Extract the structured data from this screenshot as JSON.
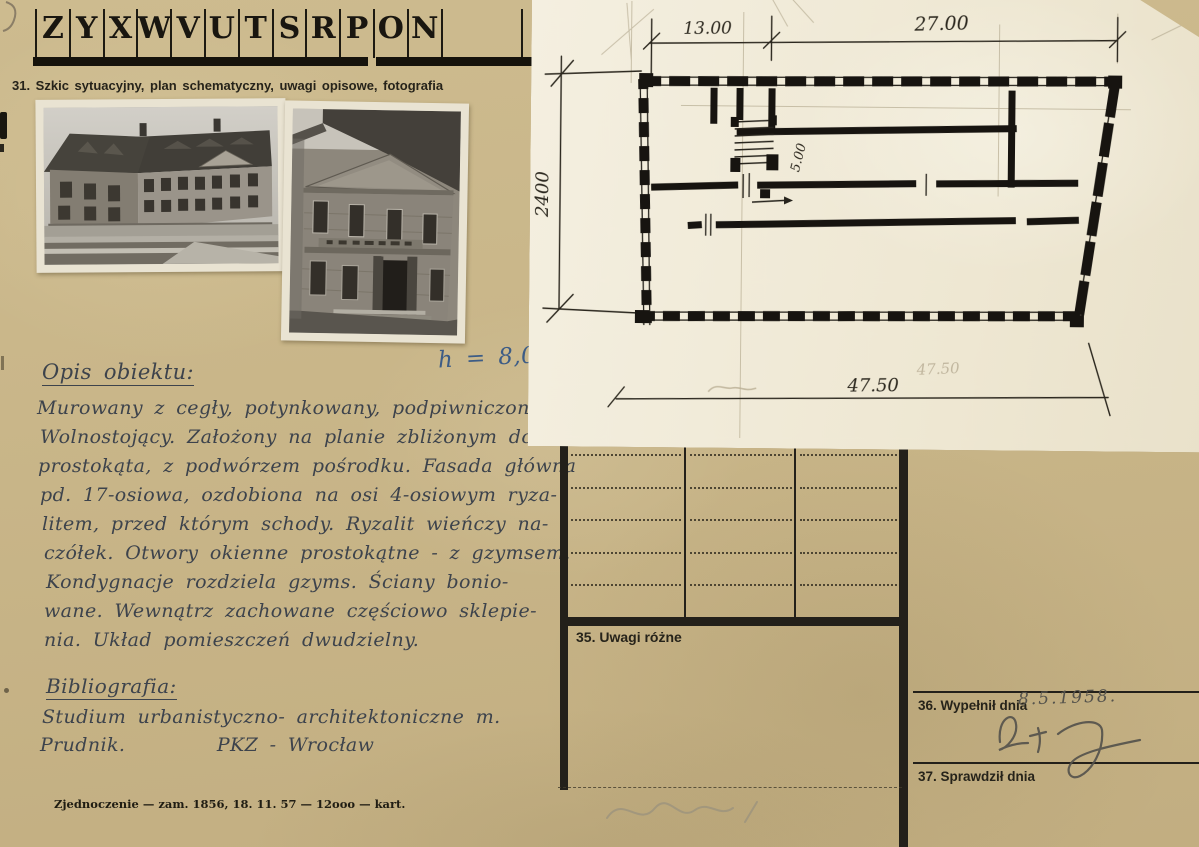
{
  "letter_strip": {
    "letters": [
      "Z",
      "Y",
      "X",
      "W",
      "V",
      "U",
      "T",
      "S",
      "R",
      "P",
      "O",
      "N"
    ]
  },
  "section31": {
    "label": "31. Szkic sytuacyjny, plan schematyczny, uwagi opisowe, fotografia"
  },
  "opis": {
    "heading": "Opis obiektu:",
    "height_note": "h = 8,0",
    "lines": [
      "Murowany z cegły, potynkowany, podpiwniczony.",
      "Wolnostojący. Założony na planie zbliżonym do",
      "prostokąta, z podwórzem pośrodku. Fasada główna",
      "pd. 17-osiowa, ozdobiona na osi 4-osiowym ryza-",
      "litem, przed którym schody. Ryzalit wieńczy na-",
      "czółek. Otwory okienne prostokątne - z gzymsem.",
      "Kondygnacje rozdziela gzyms. Ściany bonio-",
      "wane. Wewnątrz zachowane częściowo sklepie-",
      "nia. Układ pomieszczeń dwudzielny."
    ]
  },
  "bibliografia": {
    "heading": "Bibliografia:",
    "lines": [
      "Studium urbanistyczno- architektoniczne m.",
      "Prudnik.        PKZ - Wrocław"
    ]
  },
  "plan": {
    "dim_top_left": "13.00",
    "dim_top_right": "27.00",
    "dim_left": "2400",
    "dim_bottom": "47.50",
    "dim_bottom_pencil": "47.50",
    "stairs_width": "5.00"
  },
  "form": {
    "uwagi_label": "35. Uwagi różne",
    "wypelnil_label": "36. Wypełnił dnia",
    "wypelnil_date": "8.5.1958.",
    "signature": "BT. J",
    "sprawdzil_label": "37. Sprawdził dnia"
  },
  "footer": {
    "imprint": "Zjednoczenie — zam. 1856, 18. 11. 57 — 12ooo — kart."
  },
  "colors": {
    "card": "#c9b689",
    "ink_print": "#16130c",
    "ink_hand": "#3d434c",
    "ink_blue": "#3c5c86",
    "paper": "#f1ebd9",
    "pencil": "#9a927e"
  }
}
